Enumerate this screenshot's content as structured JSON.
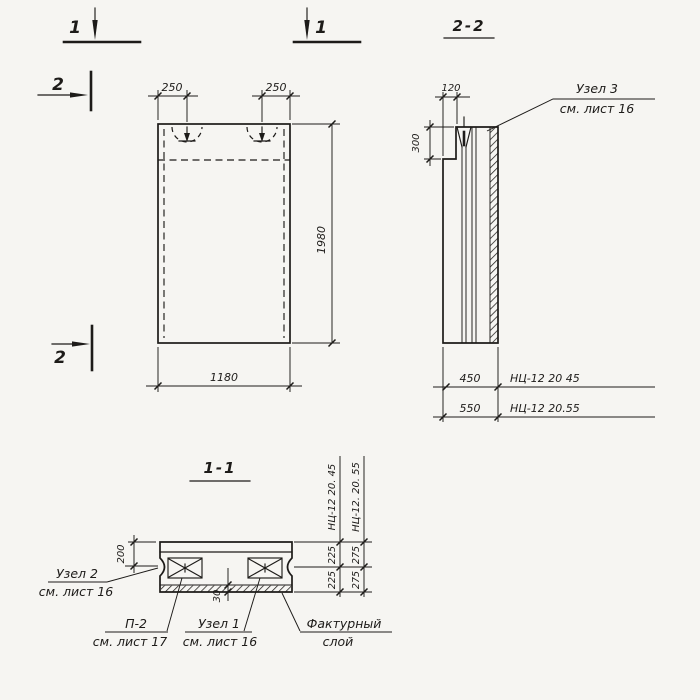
{
  "drawing": {
    "background": "#f6f5f2",
    "ink": "#1d1b19",
    "section_markers": {
      "cut1_left_label": "1",
      "cut1_right_label": "1",
      "cut2_top_label": "2",
      "cut2_bottom_label": "2"
    },
    "elevation_view": {
      "dim_loop_left": "250",
      "dim_loop_right": "250",
      "dim_height": "1980",
      "dim_width": "1180"
    },
    "section_2_2": {
      "title": "2-2",
      "dim_top_offset": "120",
      "dim_step_height": "300",
      "callout_node3_line1": "Узел 3",
      "callout_node3_line2": "см. лист 16",
      "dim_thickness_45": "450",
      "mark_45": "НЦ-12 20 45",
      "dim_thickness_55": "550",
      "mark_55": "НЦ-12 20.55"
    },
    "section_1_1": {
      "title": "1-1",
      "dim_flange": "200",
      "dim_facing_layer": "30",
      "col45_mark": "НЦ-12 20. 45",
      "col45_seg_top": "225",
      "col45_seg_bottom": "225",
      "col55_mark": "НЦ-12. 20. 55",
      "col55_seg_top": "275",
      "col55_seg_bottom": "275",
      "callout_node2_line1": "Узел 2",
      "callout_node2_line2": "см. лист 16",
      "callout_p2_line1": "П-2",
      "callout_p2_line2": "см. лист 17",
      "callout_node1_line1": "Узел 1",
      "callout_node1_line2": "см. лист 16",
      "callout_facing_line1": "Фактурный",
      "callout_facing_line2": "слой"
    }
  }
}
